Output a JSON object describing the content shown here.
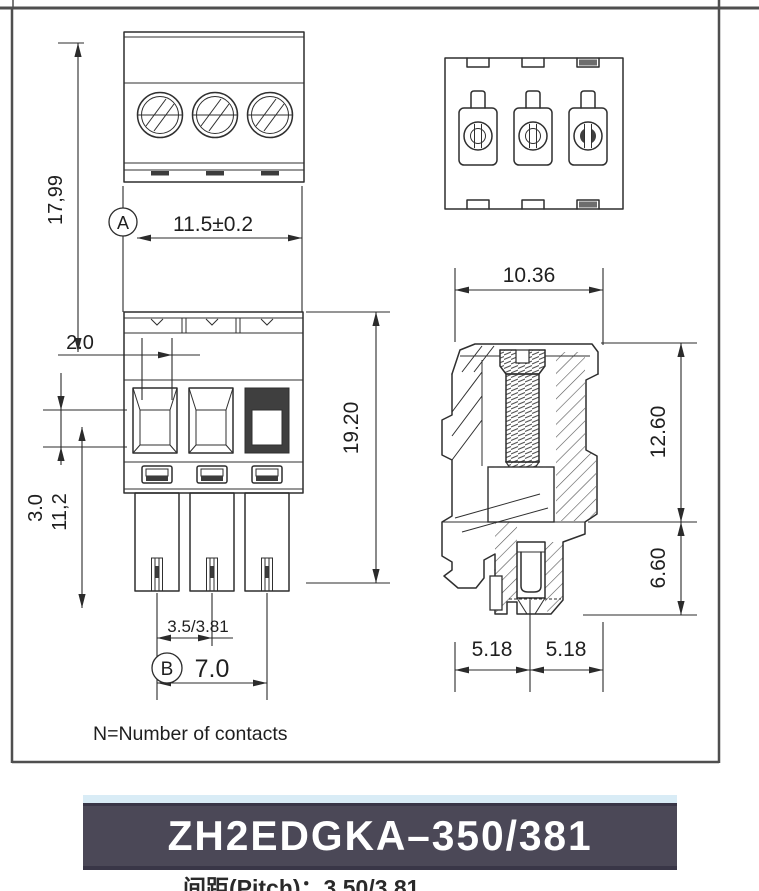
{
  "dims": {
    "overall_height": "17,99",
    "datum_a": "A",
    "width_top": "11.5±0.2",
    "wall": "2.0",
    "latch": "3.0",
    "pin_len": "11,2",
    "total_height": "19.20",
    "pitch": "3.5/3.81",
    "datum_b": "B",
    "span": "7.0",
    "depth": "10.36",
    "body_h": "12.60",
    "pin_h": "6.60",
    "off_l": "5.18",
    "off_r": "5.18"
  },
  "note": "N=Number of contacts",
  "banner": {
    "part_number": "ZH2EDGKA–350/381"
  },
  "footer": {
    "partial_spec": "间距(Pitch)：3.50/3.81"
  },
  "colors": {
    "line": "#2f2f2f",
    "banner_bg": "#4b4857",
    "banner_strip": "#d9ecf6",
    "banner_text": "#ffffff"
  }
}
